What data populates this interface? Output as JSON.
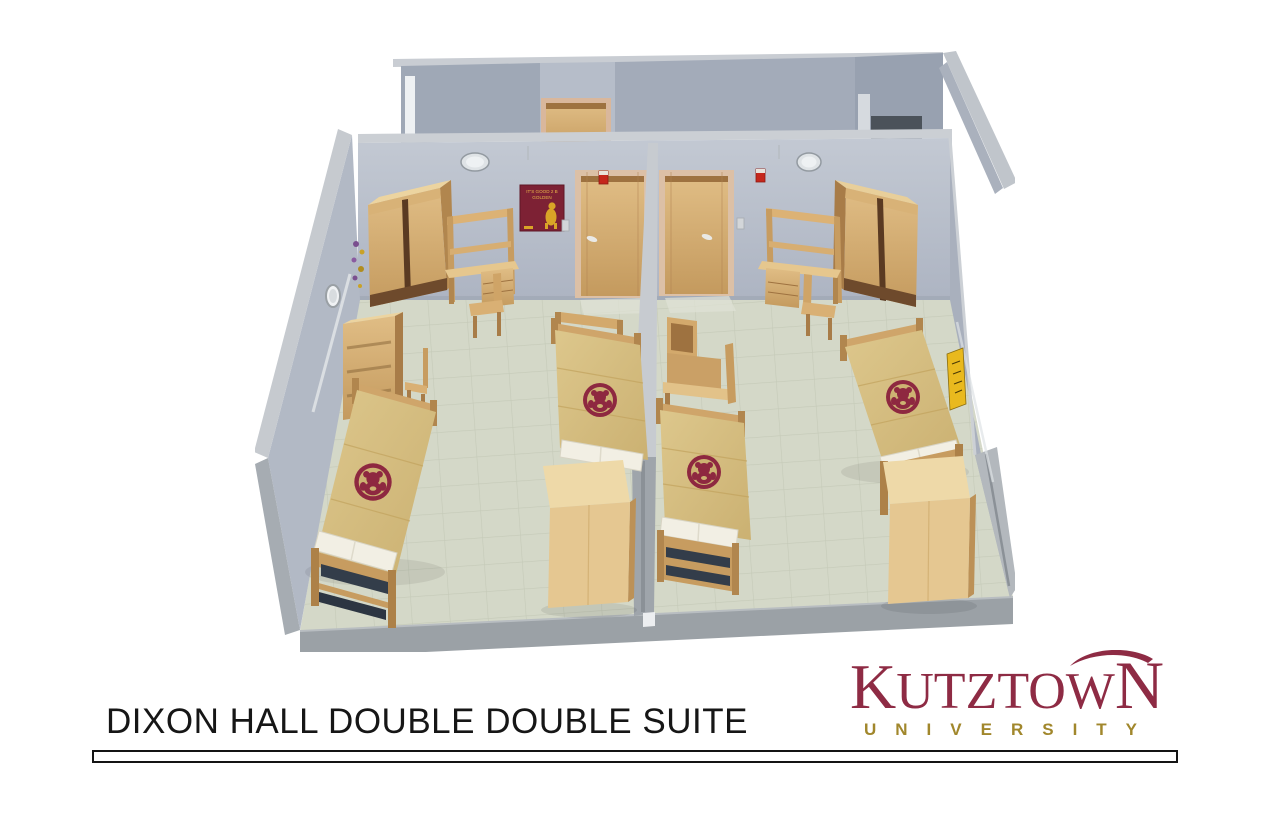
{
  "title": {
    "text": "DIXON HALL DOUBLE DOUBLE SUITE"
  },
  "logo": {
    "k": "K",
    "utztow": "UTZTOW",
    "n": "N",
    "subtitle": "UNIVERSITY",
    "maroon": "#8E2B44",
    "gold": "#A1872C"
  },
  "floorplan": {
    "poster": {
      "line1": "IT'S GOOD 2 B",
      "line2": "GOLDEN"
    },
    "palette": {
      "wall": "#B4BBC7",
      "wall_cap": "#CBCFD4",
      "floor_tile": "#D3D7C7",
      "wood_light": "#E3C58D",
      "wood_mid": "#C89E62",
      "wood_dark": "#7A5330",
      "bedspread_gold": "#D8C183",
      "bear_maroon": "#8E2840",
      "pillow_white": "#F2EFE4",
      "caution_yellow": "#E9B91E",
      "alarm_red": "#C5271C"
    }
  }
}
